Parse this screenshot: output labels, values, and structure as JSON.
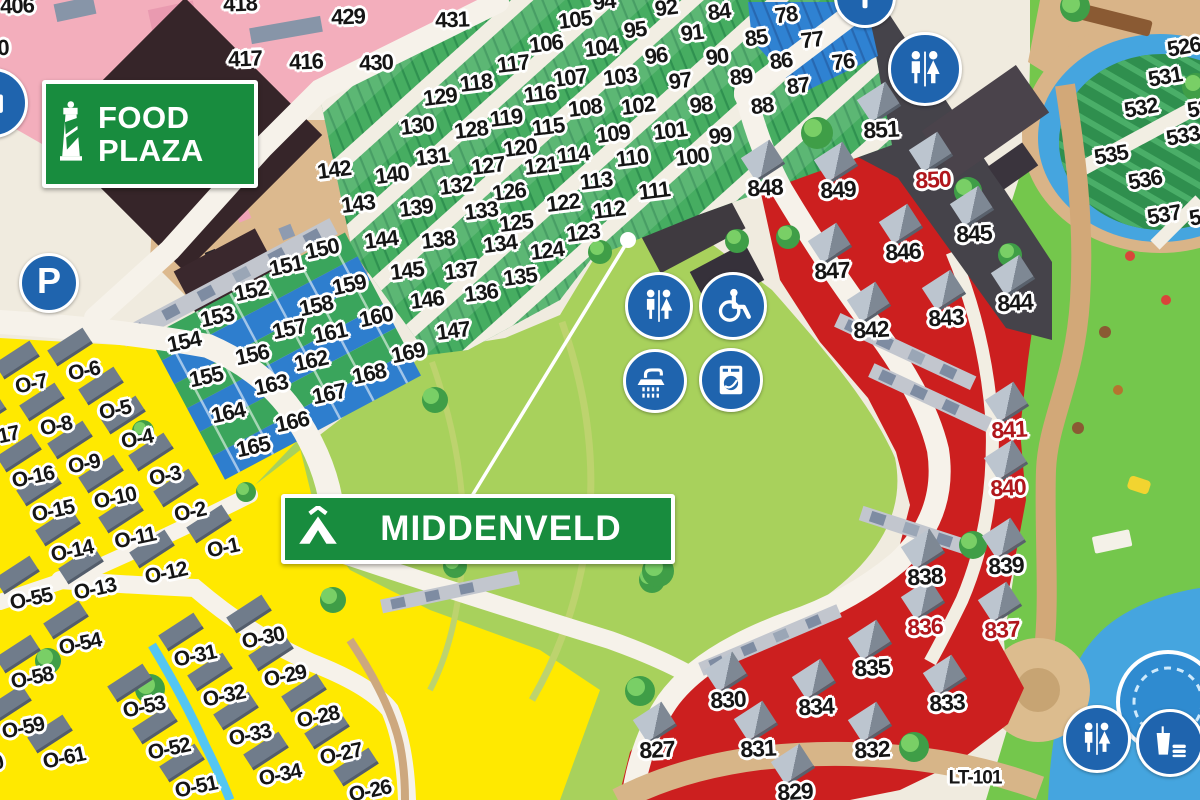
{
  "signs": {
    "food_plaza": {
      "line1": "FOOD",
      "line2": "PLAZA"
    },
    "middenveld": "MIDDENVELD",
    "parking_label": "P"
  },
  "colors": {
    "camping_zone_green": "#46ad61",
    "strip_zone_blue": "#2f82d2",
    "bungalow_zone_yellow": "#ffe900",
    "chalet_zone_red": "#cc1f1f",
    "icon_blue": "#1f64ae",
    "sign_green": "#188c3e",
    "red_plot_number": "#b0161c"
  },
  "icon_names": [
    "parking-icon",
    "info-icon",
    "toilets-icon",
    "wheelchair-icon",
    "shower-icon",
    "laundry-icon",
    "food-drink-icon"
  ],
  "plot_labels": [
    {
      "name": "pink-blocks",
      "rot": -2,
      "size": 22,
      "items": [
        {
          "t": "406",
          "x": 17,
          "y": 6
        },
        {
          "t": "0",
          "x": 3,
          "y": 48
        },
        {
          "t": "418",
          "x": 240,
          "y": 4
        },
        {
          "t": "417",
          "x": 245,
          "y": 59
        },
        {
          "t": "416",
          "x": 306,
          "y": 62
        },
        {
          "t": "429",
          "x": 348,
          "y": 17
        },
        {
          "t": "430",
          "x": 376,
          "y": 63
        },
        {
          "t": "431",
          "x": 452,
          "y": 20
        }
      ]
    },
    {
      "name": "camping-field",
      "rot": -7,
      "size": 22,
      "items": [
        {
          "t": "94",
          "x": 604,
          "y": 2
        },
        {
          "t": "92",
          "x": 666,
          "y": 8
        },
        {
          "t": "84",
          "x": 719,
          "y": 12
        },
        {
          "t": "78",
          "x": 786,
          "y": 15
        },
        {
          "t": "105",
          "x": 575,
          "y": 20
        },
        {
          "t": "95",
          "x": 635,
          "y": 30
        },
        {
          "t": "91",
          "x": 692,
          "y": 33
        },
        {
          "t": "85",
          "x": 756,
          "y": 38
        },
        {
          "t": "77",
          "x": 812,
          "y": 40
        },
        {
          "t": "106",
          "x": 546,
          "y": 44
        },
        {
          "t": "104",
          "x": 601,
          "y": 48
        },
        {
          "t": "96",
          "x": 656,
          "y": 56
        },
        {
          "t": "90",
          "x": 717,
          "y": 57
        },
        {
          "t": "86",
          "x": 781,
          "y": 61
        },
        {
          "t": "76",
          "x": 843,
          "y": 62
        },
        {
          "t": "117",
          "x": 513,
          "y": 64
        },
        {
          "t": "107",
          "x": 570,
          "y": 78
        },
        {
          "t": "103",
          "x": 620,
          "y": 77
        },
        {
          "t": "97",
          "x": 680,
          "y": 81
        },
        {
          "t": "89",
          "x": 741,
          "y": 77
        },
        {
          "t": "87",
          "x": 798,
          "y": 86
        },
        {
          "t": "118",
          "x": 476,
          "y": 83
        },
        {
          "t": "116",
          "x": 540,
          "y": 94
        },
        {
          "t": "108",
          "x": 585,
          "y": 108
        },
        {
          "t": "102",
          "x": 638,
          "y": 106
        },
        {
          "t": "98",
          "x": 701,
          "y": 105
        },
        {
          "t": "88",
          "x": 762,
          "y": 106
        },
        {
          "t": "129",
          "x": 440,
          "y": 97
        },
        {
          "t": "130",
          "x": 417,
          "y": 126
        },
        {
          "t": "128",
          "x": 471,
          "y": 130
        },
        {
          "t": "119",
          "x": 506,
          "y": 118
        },
        {
          "t": "115",
          "x": 548,
          "y": 127
        },
        {
          "t": "109",
          "x": 613,
          "y": 134
        },
        {
          "t": "101",
          "x": 670,
          "y": 131
        },
        {
          "t": "99",
          "x": 720,
          "y": 136
        },
        {
          "t": "131",
          "x": 432,
          "y": 157
        },
        {
          "t": "120",
          "x": 520,
          "y": 148
        },
        {
          "t": "114",
          "x": 573,
          "y": 155
        },
        {
          "t": "110",
          "x": 632,
          "y": 158
        },
        {
          "t": "100",
          "x": 692,
          "y": 157
        },
        {
          "t": "142",
          "x": 334,
          "y": 170
        },
        {
          "t": "140",
          "x": 392,
          "y": 175
        },
        {
          "t": "127",
          "x": 488,
          "y": 166
        },
        {
          "t": "121",
          "x": 541,
          "y": 166
        },
        {
          "t": "113",
          "x": 596,
          "y": 181
        },
        {
          "t": "143",
          "x": 358,
          "y": 204
        },
        {
          "t": "139",
          "x": 416,
          "y": 208
        },
        {
          "t": "132",
          "x": 456,
          "y": 186
        },
        {
          "t": "126",
          "x": 509,
          "y": 192
        },
        {
          "t": "122",
          "x": 563,
          "y": 203
        },
        {
          "t": "111",
          "x": 654,
          "y": 191
        },
        {
          "t": "144",
          "x": 381,
          "y": 240
        },
        {
          "t": "138",
          "x": 438,
          "y": 240
        },
        {
          "t": "133",
          "x": 481,
          "y": 211
        },
        {
          "t": "125",
          "x": 516,
          "y": 223
        },
        {
          "t": "112",
          "x": 609,
          "y": 210
        },
        {
          "t": "145",
          "x": 407,
          "y": 271
        },
        {
          "t": "137",
          "x": 461,
          "y": 271
        },
        {
          "t": "134",
          "x": 500,
          "y": 244
        },
        {
          "t": "124",
          "x": 547,
          "y": 251
        },
        {
          "t": "123",
          "x": 583,
          "y": 233
        },
        {
          "t": "146",
          "x": 427,
          "y": 300
        },
        {
          "t": "136",
          "x": 481,
          "y": 293
        },
        {
          "t": "135",
          "x": 520,
          "y": 277
        },
        {
          "t": "147",
          "x": 453,
          "y": 331
        }
      ]
    },
    {
      "name": "strip-parcels",
      "rot": -12,
      "size": 22,
      "items": [
        {
          "t": "150",
          "x": 322,
          "y": 249
        },
        {
          "t": "151",
          "x": 286,
          "y": 266
        },
        {
          "t": "152",
          "x": 251,
          "y": 291
        },
        {
          "t": "153",
          "x": 217,
          "y": 317
        },
        {
          "t": "154",
          "x": 184,
          "y": 342
        },
        {
          "t": "155",
          "x": 206,
          "y": 377
        },
        {
          "t": "156",
          "x": 252,
          "y": 355
        },
        {
          "t": "157",
          "x": 289,
          "y": 329
        },
        {
          "t": "158",
          "x": 316,
          "y": 306
        },
        {
          "t": "159",
          "x": 349,
          "y": 285
        },
        {
          "t": "160",
          "x": 376,
          "y": 317
        },
        {
          "t": "161",
          "x": 330,
          "y": 333
        },
        {
          "t": "162",
          "x": 311,
          "y": 361
        },
        {
          "t": "163",
          "x": 271,
          "y": 385
        },
        {
          "t": "164",
          "x": 228,
          "y": 413
        },
        {
          "t": "165",
          "x": 253,
          "y": 447
        },
        {
          "t": "166",
          "x": 292,
          "y": 422
        },
        {
          "t": "167",
          "x": 329,
          "y": 394
        },
        {
          "t": "168",
          "x": 369,
          "y": 374
        },
        {
          "t": "169",
          "x": 408,
          "y": 353
        }
      ]
    },
    {
      "name": "bungalows-O",
      "rot": -12,
      "size": 21,
      "house": "yellow",
      "items": [
        {
          "t": "O-7",
          "x": 31,
          "y": 384
        },
        {
          "t": "O-6",
          "x": 84,
          "y": 371
        },
        {
          "t": "O-5",
          "x": 115,
          "y": 410
        },
        {
          "t": "O-8",
          "x": 56,
          "y": 426
        },
        {
          "t": "O-17",
          "x": -2,
          "y": 437
        },
        {
          "t": "O-4",
          "x": 137,
          "y": 439
        },
        {
          "t": "O-16",
          "x": 33,
          "y": 477
        },
        {
          "t": "O-9",
          "x": 84,
          "y": 464
        },
        {
          "t": "O-3",
          "x": 165,
          "y": 476
        },
        {
          "t": "O-15",
          "x": 53,
          "y": 511
        },
        {
          "t": "O-10",
          "x": 115,
          "y": 498
        },
        {
          "t": "O-2",
          "x": 190,
          "y": 512
        },
        {
          "t": "O-14",
          "x": 72,
          "y": 551
        },
        {
          "t": "O-11",
          "x": 135,
          "y": 538
        },
        {
          "t": "O-1",
          "x": 223,
          "y": 548
        },
        {
          "t": "O-12",
          "x": 166,
          "y": 573
        },
        {
          "t": "O-13",
          "x": 95,
          "y": 589
        },
        {
          "t": "O-55",
          "x": 31,
          "y": 599
        },
        {
          "t": "O-54",
          "x": 80,
          "y": 644
        },
        {
          "t": "O-58",
          "x": 32,
          "y": 678
        },
        {
          "t": "O-59",
          "x": 23,
          "y": 728
        },
        {
          "t": "O-61",
          "x": 64,
          "y": 758
        },
        {
          "t": "O-60",
          "x": -18,
          "y": 766
        },
        {
          "t": "O-53",
          "x": 144,
          "y": 707
        },
        {
          "t": "O-52",
          "x": 169,
          "y": 749
        },
        {
          "t": "O-51",
          "x": 196,
          "y": 787
        },
        {
          "t": "O-31",
          "x": 195,
          "y": 656
        },
        {
          "t": "O-30",
          "x": 263,
          "y": 638
        },
        {
          "t": "O-32",
          "x": 224,
          "y": 696
        },
        {
          "t": "O-29",
          "x": 285,
          "y": 676
        },
        {
          "t": "O-33",
          "x": 250,
          "y": 735
        },
        {
          "t": "O-28",
          "x": 318,
          "y": 717
        },
        {
          "t": "O-27",
          "x": 341,
          "y": 754
        },
        {
          "t": "O-34",
          "x": 280,
          "y": 775
        },
        {
          "t": "O-26",
          "x": 370,
          "y": 791
        }
      ]
    },
    {
      "name": "chalets-800",
      "rot": -3,
      "size": 23,
      "house": "red",
      "items": [
        {
          "t": "851",
          "x": 881,
          "y": 130
        },
        {
          "t": "848",
          "x": 765,
          "y": 188
        },
        {
          "t": "849",
          "x": 838,
          "y": 190
        },
        {
          "t": "850",
          "x": 933,
          "y": 180,
          "c": "#b0161c"
        },
        {
          "t": "847",
          "x": 832,
          "y": 271
        },
        {
          "t": "846",
          "x": 903,
          "y": 252
        },
        {
          "t": "845",
          "x": 974,
          "y": 234
        },
        {
          "t": "842",
          "x": 871,
          "y": 330
        },
        {
          "t": "843",
          "x": 946,
          "y": 318
        },
        {
          "t": "844",
          "x": 1015,
          "y": 303
        },
        {
          "t": "841",
          "x": 1009,
          "y": 430,
          "c": "#b0161c"
        },
        {
          "t": "840",
          "x": 1008,
          "y": 488,
          "c": "#b0161c"
        },
        {
          "t": "839",
          "x": 1006,
          "y": 566
        },
        {
          "t": "838",
          "x": 925,
          "y": 577
        },
        {
          "t": "836",
          "x": 925,
          "y": 627,
          "c": "#b0161c"
        },
        {
          "t": "837",
          "x": 1002,
          "y": 630,
          "c": "#b0161c"
        },
        {
          "t": "835",
          "x": 872,
          "y": 668
        },
        {
          "t": "834",
          "x": 816,
          "y": 707
        },
        {
          "t": "833",
          "x": 947,
          "y": 703
        },
        {
          "t": "830",
          "x": 728,
          "y": 700
        },
        {
          "t": "831",
          "x": 758,
          "y": 749
        },
        {
          "t": "832",
          "x": 872,
          "y": 750
        },
        {
          "t": "827",
          "x": 657,
          "y": 750
        },
        {
          "t": "829",
          "x": 795,
          "y": 792
        }
      ]
    },
    {
      "name": "parcels-500",
      "rot": -10,
      "size": 22,
      "items": [
        {
          "t": "526",
          "x": 1184,
          "y": 47
        },
        {
          "t": "531",
          "x": 1165,
          "y": 77
        },
        {
          "t": "532",
          "x": 1141,
          "y": 108
        },
        {
          "t": "534",
          "x": 1204,
          "y": 108
        },
        {
          "t": "533",
          "x": 1183,
          "y": 136
        },
        {
          "t": "535",
          "x": 1111,
          "y": 155
        },
        {
          "t": "536",
          "x": 1145,
          "y": 180
        },
        {
          "t": "537",
          "x": 1164,
          "y": 215
        },
        {
          "t": "538",
          "x": 1206,
          "y": 216
        }
      ]
    },
    {
      "name": "road-ref",
      "rot": 0,
      "size": 19,
      "items": [
        {
          "t": "LT-101",
          "x": 975,
          "y": 778
        }
      ]
    }
  ]
}
